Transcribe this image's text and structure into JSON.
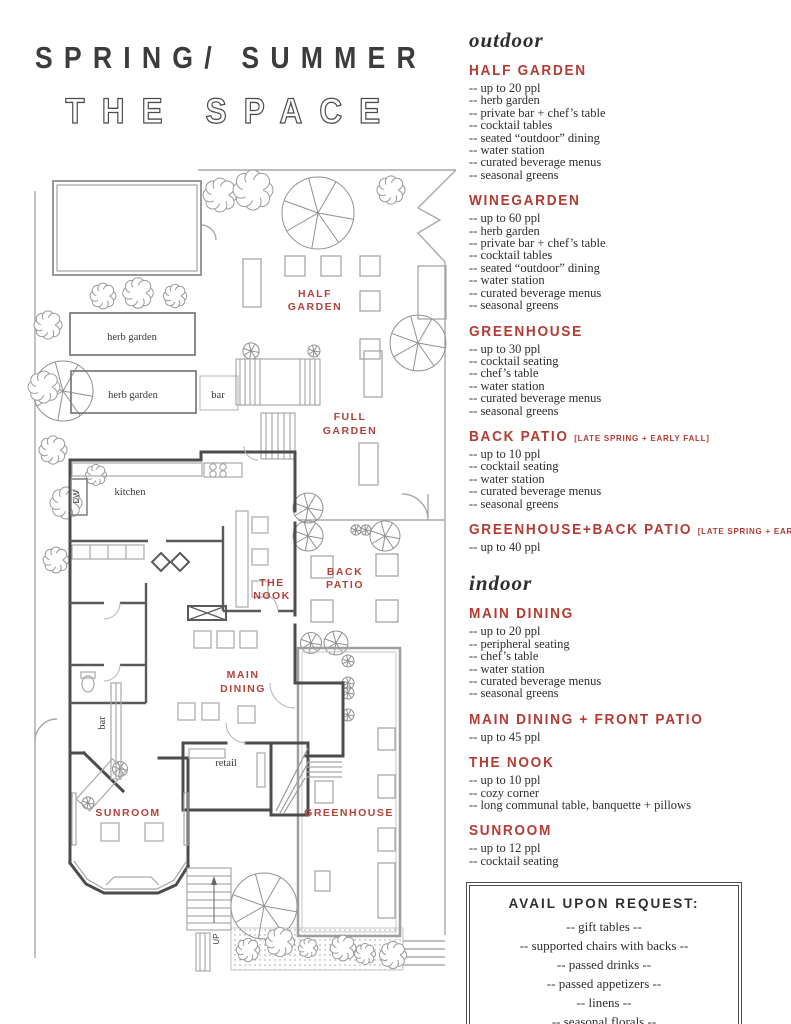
{
  "title": {
    "line1": "SPRING/ SUMMER",
    "line2": "THE SPACE"
  },
  "colors": {
    "accent_red": "#b23b33",
    "wall_gray": "#4c4c4c",
    "light_gray": "#a9a9a9"
  },
  "right": {
    "outdoor": {
      "heading": "outdoor",
      "sections": [
        {
          "label": "HALF GARDEN",
          "items": [
            "-- up to 20 ppl",
            "-- herb garden",
            "-- private bar + chef’s table",
            "-- cocktail tables",
            "-- seated “outdoor” dining",
            "-- water station",
            "-- curated beverage menus",
            "-- seasonal greens"
          ]
        },
        {
          "label": "WINEGARDEN",
          "items": [
            "-- up to 60 ppl",
            "-- herb garden",
            "-- private bar + chef’s table",
            "-- cocktail tables",
            "-- seated “outdoor” dining",
            "-- water station",
            "-- curated beverage menus",
            "-- seasonal greens"
          ]
        },
        {
          "label": "GREENHOUSE",
          "items": [
            "-- up to 30 ppl",
            "-- cocktail seating",
            "-- chef’s table",
            "-- water station",
            "-- curated beverage menus",
            "-- seasonal greens"
          ]
        },
        {
          "label": "BACK PATIO",
          "note": "[LATE SPRING + EARLY FALL]",
          "items": [
            "-- up to 10 ppl",
            "-- cocktail seating",
            "-- water station",
            "-- curated beverage menus",
            "-- seasonal greens"
          ]
        },
        {
          "label": "GREENHOUSE+BACK PATIO",
          "note": "[LATE SPRING + EARLY FALL]",
          "items": [
            "-- up to 40 ppl"
          ]
        }
      ]
    },
    "indoor": {
      "heading": "indoor",
      "sections": [
        {
          "label": "MAIN DINING",
          "items": [
            "-- up to 20 ppl",
            "-- peripheral seating",
            "-- chef’s table",
            "-- water station",
            "-- curated beverage menus",
            "-- seasonal greens"
          ]
        },
        {
          "label": "MAIN DINING + FRONT PATIO",
          "items": [
            "-- up to 45 ppl"
          ]
        },
        {
          "label": "THE NOOK",
          "items": [
            "-- up to 10 ppl",
            "-- cozy corner",
            "-- long communal table, banquette + pillows"
          ]
        },
        {
          "label": "SUNROOM",
          "items": [
            "-- up to 12 ppl",
            "-- cocktail seating"
          ]
        }
      ]
    },
    "request_box": {
      "title": "AVAIL UPON REQUEST:",
      "items": [
        "-- gift tables --",
        "-- supported chairs with backs --",
        "-- passed drinks --",
        "-- passed appetizers --",
        "-- linens --",
        "-- seasonal florals --"
      ],
      "footnote": "* additional cost"
    }
  },
  "plan": {
    "labels": {
      "half_garden": [
        "HALF",
        "GARDEN"
      ],
      "full_garden": [
        "FULL",
        "GARDEN"
      ],
      "the_nook": [
        "THE",
        "NOOK"
      ],
      "back_patio": [
        "BACK",
        "PATIO"
      ],
      "main_dining": [
        "MAIN",
        "DINING"
      ],
      "sunroom": "SUNROOM",
      "greenhouse": "GREENHOUSE",
      "herb_garden": "herb garden",
      "bar": "bar",
      "kitchen": "kitchen",
      "dw": "DW",
      "retail": "retail",
      "up": "UP"
    }
  }
}
